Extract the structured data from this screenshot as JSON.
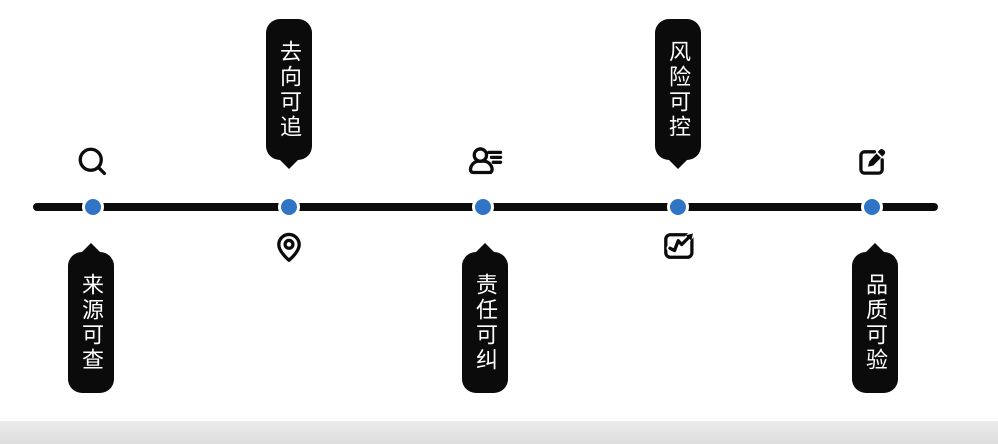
{
  "colors": {
    "accent_blue": "#2f74c5",
    "line_black": "#0b0b0b",
    "bubble_bg": "#0b0b0b",
    "bubble_text": "#ffffff",
    "footer_gray": "#e2e2e2"
  },
  "timeline": {
    "description": "horizontal traceability timeline with 5 nodes",
    "items": [
      {
        "label": "来源可查",
        "icon": "search-icon",
        "icon_position": "above",
        "bubble_position": "below"
      },
      {
        "label": "去向可追",
        "icon": "location-pin-icon",
        "icon_position": "below",
        "bubble_position": "above"
      },
      {
        "label": "责任可纠",
        "icon": "user-list-icon",
        "icon_position": "above",
        "bubble_position": "below"
      },
      {
        "label": "风险可控",
        "icon": "chart-trend-icon",
        "icon_position": "below",
        "bubble_position": "above"
      },
      {
        "label": "品质可验",
        "icon": "edit-icon",
        "icon_position": "above",
        "bubble_position": "below"
      }
    ]
  }
}
